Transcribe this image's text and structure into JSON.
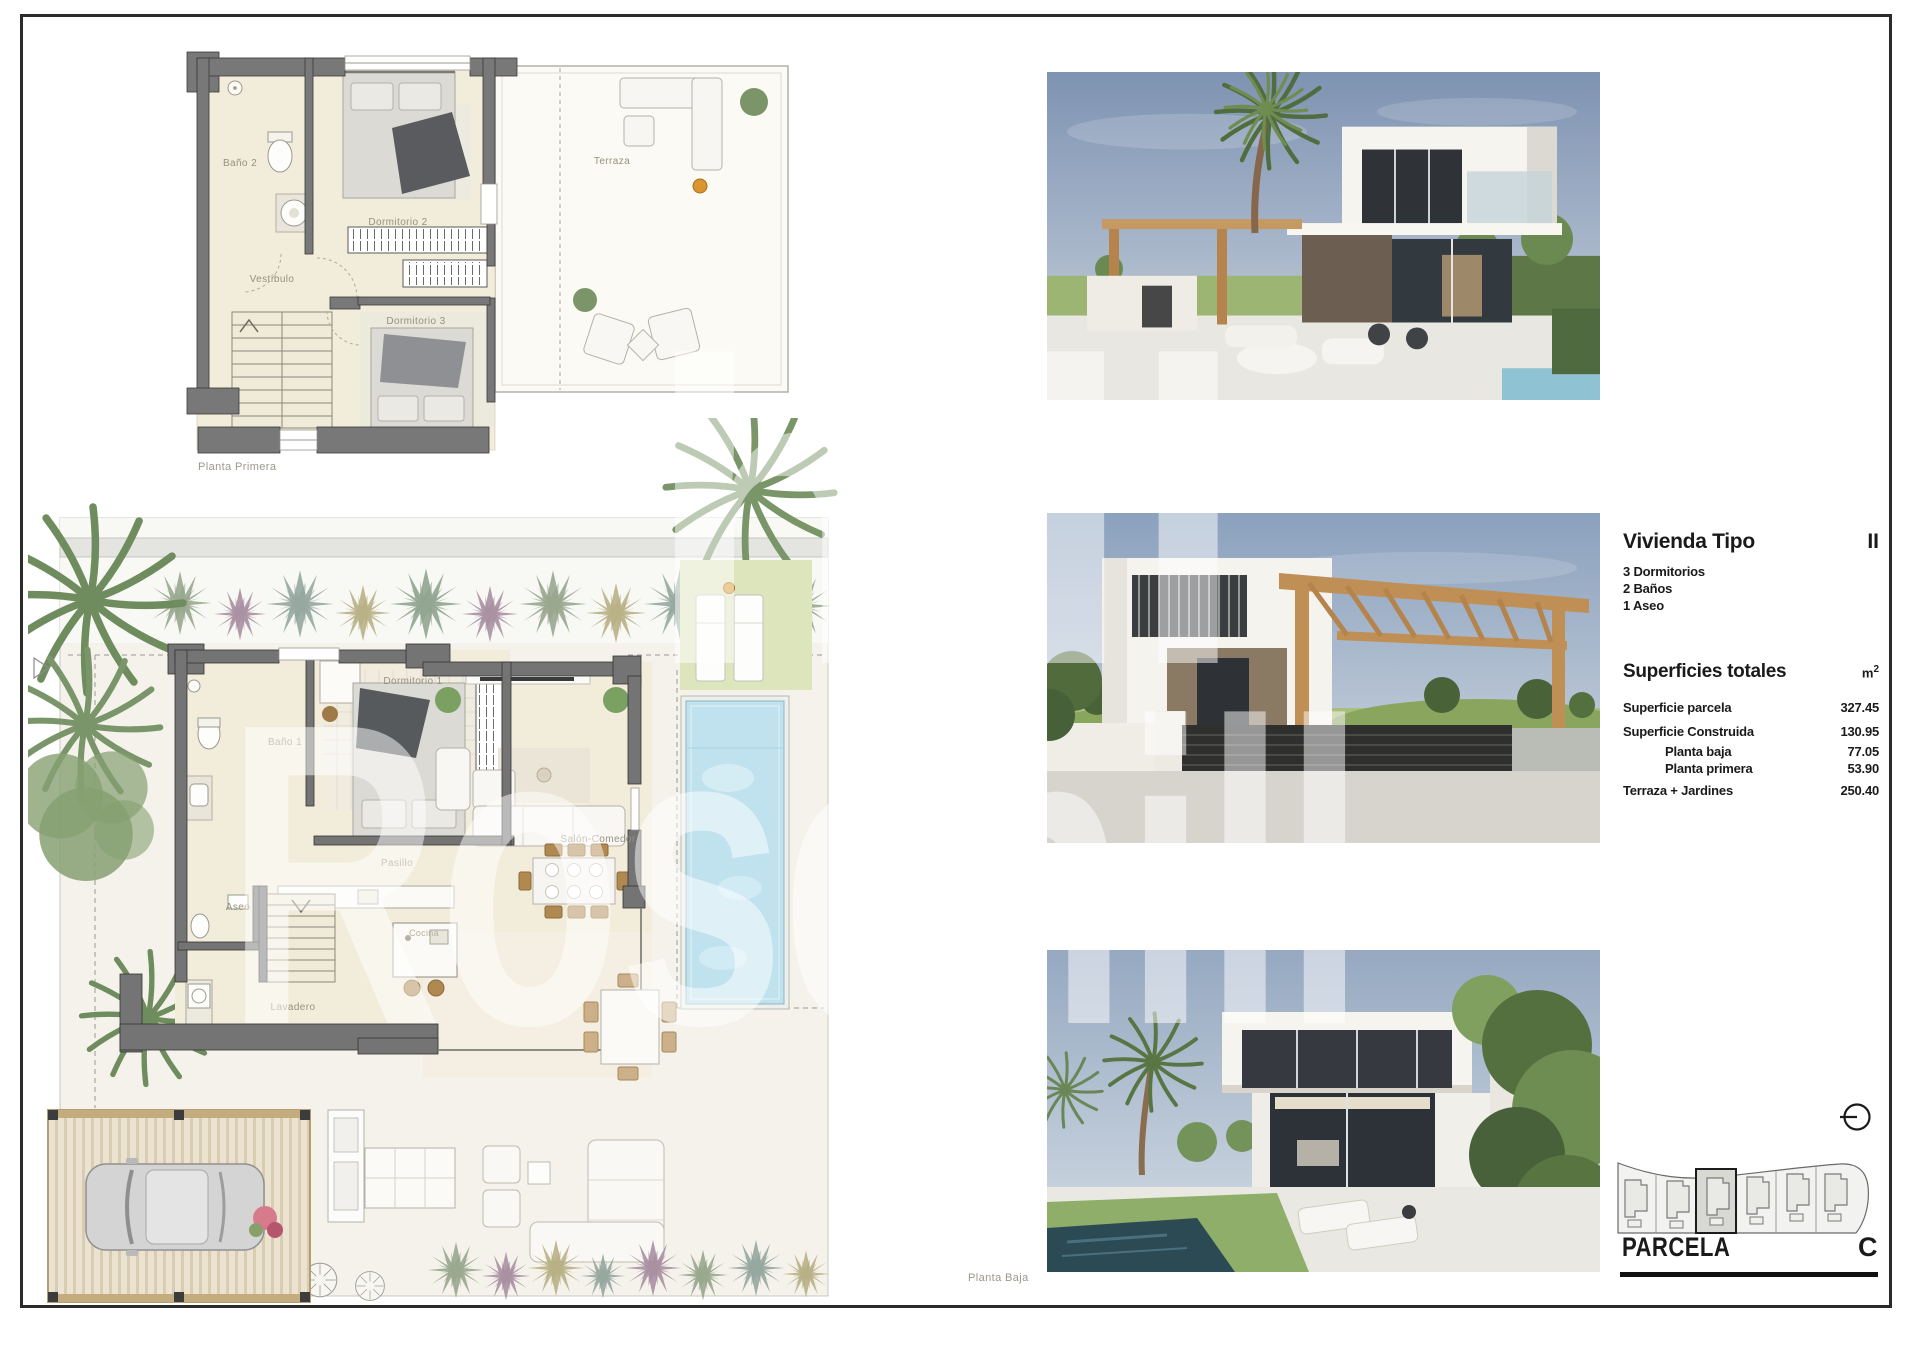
{
  "sheet": {
    "watermark": "Rosehill",
    "watermark_fragment": "hill"
  },
  "plans": {
    "planta_primera": {
      "caption": "Planta Primera",
      "rooms": {
        "bano2": "Baño 2",
        "vestibulo": "Vestíbulo",
        "dormitorio2": "Dormitorio 2",
        "dormitorio3": "Dormitorio 3",
        "terraza": "Terraza"
      }
    },
    "planta_baja": {
      "caption": "Planta Baja",
      "rooms": {
        "bano1": "Baño 1",
        "dormitorio1": "Dormitorio 1",
        "pasillo": "Pasillo",
        "salon": "Salón-Comedor",
        "aseo": "Aseo",
        "cocina": "Cocina",
        "lavadero": "Lavadero"
      }
    }
  },
  "info": {
    "title_label": "Vivienda Tipo",
    "title_value": "II",
    "features": {
      "f1": "3 Dormitorios",
      "f2": "2 Baños",
      "f3": "1 Aseo"
    },
    "areas_heading": "Superficies totales",
    "unit": "m",
    "unit_exp": "2",
    "rows": [
      {
        "label": "Superficie parcela",
        "value": "327.45"
      },
      {
        "label": "Superficie Construida",
        "value": "130.95"
      },
      {
        "label": "Planta baja",
        "value": "77.05"
      },
      {
        "label": "Planta primera",
        "value": "53.90"
      },
      {
        "label": "Terraza + Jardines",
        "value": "250.40"
      }
    ]
  },
  "parcela": {
    "label": "PARCELA",
    "value": "C"
  },
  "colors": {
    "pool_water": "#bfe2ee",
    "pergola_wood": "#c49a62",
    "wall_gray": "#757575",
    "frame_black": "#2b2b2b"
  }
}
